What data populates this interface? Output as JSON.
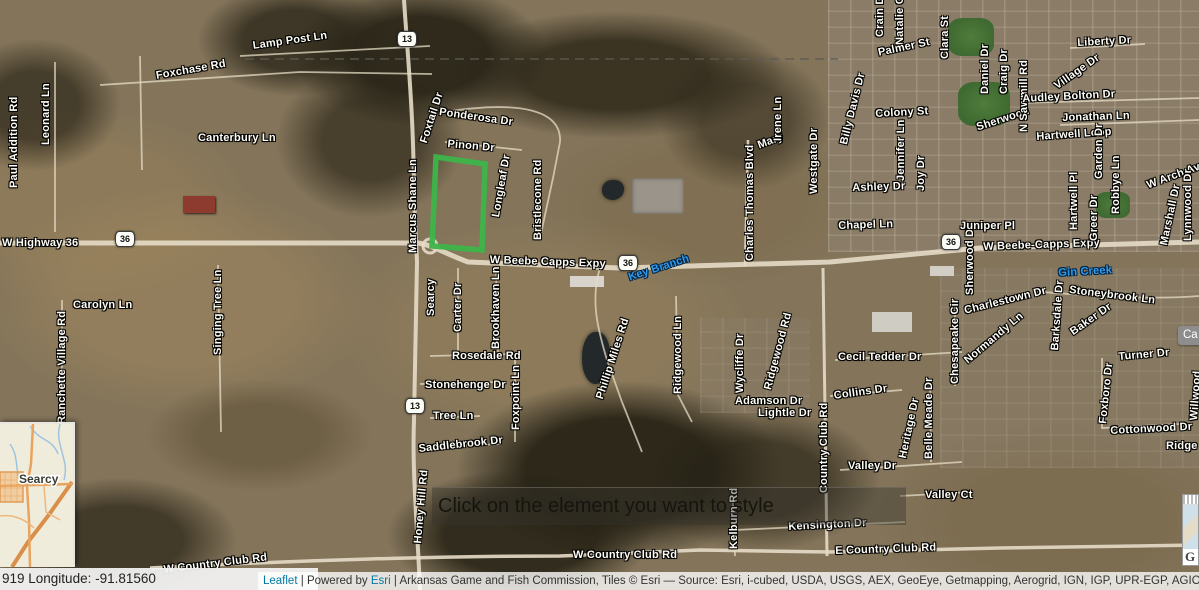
{
  "map": {
    "overlay_tooltip": "Click on the element you want to style",
    "coordinate_bar": "919 Longitude: -91.81560",
    "attribution": {
      "leaflet_link": "Leaflet",
      "divider": "|",
      "powered_prefix": "Powered by",
      "esri_link": "Esri",
      "tail": "| Arkansas Game and Fish Commission, Tiles © Esri — Source: Esri, i-cubed, USDA, USGS, AEX, GeoEye, Getmapping, Aerogrid, IGN, IGP, UPR-EGP, AGIO, and the GIS Use"
    },
    "inset": {
      "city_label": "Searcy"
    },
    "cutoff_button_label": "Ca",
    "corner_widget_letter": "G",
    "highlight_polygon": {
      "color": "#3db54a",
      "points": "436,157 485,164 482,250 432,246"
    },
    "shields": [
      {
        "text": "36",
        "x": 115,
        "y": 231
      },
      {
        "text": "36",
        "x": 618,
        "y": 255
      },
      {
        "text": "36",
        "x": 941,
        "y": 234
      },
      {
        "text": "13",
        "x": 397,
        "y": 31
      },
      {
        "text": "13",
        "x": 405,
        "y": 398
      }
    ],
    "street_labels": [
      {
        "text": "Lamp Post Ln",
        "x": 252,
        "y": 40,
        "r": -8
      },
      {
        "text": "Foxchase Rd",
        "x": 155,
        "y": 70,
        "r": -10
      },
      {
        "text": "Canterbury Ln",
        "x": 198,
        "y": 132
      },
      {
        "text": "Paul Addition Rd",
        "x": 8,
        "y": 188,
        "r": -90
      },
      {
        "text": "Leonard Ln",
        "x": 40,
        "y": 145,
        "r": -90
      },
      {
        "text": "W Highway 36",
        "x": 2,
        "y": 237
      },
      {
        "text": "Carolyn Ln",
        "x": 73,
        "y": 299
      },
      {
        "text": "Singing Tree Ln",
        "x": 212,
        "y": 355,
        "r": -90
      },
      {
        "text": "Ranchette Village Rd",
        "x": 56,
        "y": 424,
        "r": -90
      },
      {
        "text": "W Country Club Rd",
        "x": 163,
        "y": 564,
        "r": -7
      },
      {
        "text": "Foxtail Dr",
        "x": 418,
        "y": 141,
        "r": -72
      },
      {
        "text": "Ponderosa Dr",
        "x": 440,
        "y": 106,
        "r": 8
      },
      {
        "text": "Pinon Dr",
        "x": 448,
        "y": 138,
        "r": 5
      },
      {
        "text": "Longleaf Dr",
        "x": 490,
        "y": 216,
        "r": -80
      },
      {
        "text": "Bristlecone Rd",
        "x": 532,
        "y": 240,
        "r": -90
      },
      {
        "text": "Marcus Shane Ln",
        "x": 407,
        "y": 253,
        "r": -90
      },
      {
        "text": "W Beebe Capps Expy",
        "x": 490,
        "y": 254,
        "r": 2
      },
      {
        "text": "Searcy",
        "x": 425,
        "y": 316,
        "r": -90
      },
      {
        "text": "Carter Dr",
        "x": 452,
        "y": 332,
        "r": -90
      },
      {
        "text": "Brookhaven Ln",
        "x": 490,
        "y": 349,
        "r": -90
      },
      {
        "text": "Rosedale Rd",
        "x": 452,
        "y": 350
      },
      {
        "text": "Stonehenge Dr",
        "x": 425,
        "y": 379
      },
      {
        "text": "Foxpoint Ln",
        "x": 510,
        "y": 430,
        "r": -90
      },
      {
        "text": "Tree Ln",
        "x": 433,
        "y": 410
      },
      {
        "text": "Saddlebrook Dr",
        "x": 418,
        "y": 443,
        "r": -6
      },
      {
        "text": "Honey Hill Rd",
        "x": 412,
        "y": 543,
        "r": -85
      },
      {
        "text": "Phillip Miles Rd",
        "x": 594,
        "y": 397,
        "r": -72
      },
      {
        "text": "Ridgewood Ln",
        "x": 672,
        "y": 394,
        "r": -90
      },
      {
        "text": "Kelburn Rd",
        "x": 728,
        "y": 549,
        "r": -90
      },
      {
        "text": "W Country Club Rd",
        "x": 573,
        "y": 549
      },
      {
        "text": "Kensington Dr",
        "x": 788,
        "y": 521,
        "r": -3
      },
      {
        "text": "E Country Club Rd",
        "x": 835,
        "y": 545,
        "r": -2
      },
      {
        "text": "Valley Dr",
        "x": 848,
        "y": 460
      },
      {
        "text": "Valley Ct",
        "x": 925,
        "y": 489
      },
      {
        "text": "Country Club Rd",
        "x": 818,
        "y": 493,
        "r": -90
      },
      {
        "text": "Adamson Dr",
        "x": 735,
        "y": 395
      },
      {
        "text": "Lightle Dr",
        "x": 758,
        "y": 407
      },
      {
        "text": "Collins Dr",
        "x": 833,
        "y": 390,
        "r": -8
      },
      {
        "text": "Cecil Tedder Dr",
        "x": 838,
        "y": 351
      },
      {
        "text": "Wycliffe Dr",
        "x": 734,
        "y": 393,
        "r": -90
      },
      {
        "text": "Ridgewood Rd",
        "x": 762,
        "y": 388,
        "r": -75
      },
      {
        "text": "Belle Meade Dr",
        "x": 923,
        "y": 459,
        "r": -90
      },
      {
        "text": "Heritage Dr",
        "x": 897,
        "y": 457,
        "r": -78
      },
      {
        "text": "Chesapeake Cir",
        "x": 949,
        "y": 384,
        "r": -90
      },
      {
        "text": "Normandy Ln",
        "x": 962,
        "y": 357,
        "r": -40
      },
      {
        "text": "Charlestown Dr",
        "x": 963,
        "y": 305,
        "r": -14
      },
      {
        "text": "Sherwood Dr",
        "x": 964,
        "y": 295,
        "r": -90
      },
      {
        "text": "Stoneybrook Ln",
        "x": 1070,
        "y": 284,
        "r": 7
      },
      {
        "text": "Barksdale Dr",
        "x": 1049,
        "y": 350,
        "r": -86
      },
      {
        "text": "Baker Dr",
        "x": 1068,
        "y": 328,
        "r": -35
      },
      {
        "text": "Juniper Pl",
        "x": 960,
        "y": 220
      },
      {
        "text": "W Beebe-Capps Expy",
        "x": 983,
        "y": 241,
        "r": -2
      },
      {
        "text": "Turner Dr",
        "x": 1118,
        "y": 351,
        "r": -5
      },
      {
        "text": "Foxboro Dr",
        "x": 1097,
        "y": 423,
        "r": -84
      },
      {
        "text": "Willwood",
        "x": 1188,
        "y": 420,
        "r": -86
      },
      {
        "text": "Cottonwood Dr",
        "x": 1110,
        "y": 425,
        "r": -3
      },
      {
        "text": "Ridge R",
        "x": 1166,
        "y": 440
      },
      {
        "text": "Charles Thomas Blvd",
        "x": 744,
        "y": 261,
        "r": -90
      },
      {
        "text": "Mary",
        "x": 756,
        "y": 140,
        "r": -20
      },
      {
        "text": "Irene Ln",
        "x": 772,
        "y": 141,
        "r": -90
      },
      {
        "text": "Westgate Dr",
        "x": 808,
        "y": 194,
        "r": -90
      },
      {
        "text": "Billy Davis Dr",
        "x": 838,
        "y": 143,
        "r": -76
      },
      {
        "text": "Colony St",
        "x": 875,
        "y": 108,
        "r": -3
      },
      {
        "text": "Jennifer Ln",
        "x": 895,
        "y": 181,
        "r": -90
      },
      {
        "text": "Joy Dr",
        "x": 915,
        "y": 191,
        "r": -90
      },
      {
        "text": "Ashley Dr",
        "x": 852,
        "y": 182,
        "r": -2
      },
      {
        "text": "Chapel Ln",
        "x": 838,
        "y": 220,
        "r": -2
      },
      {
        "text": "Crain Dr",
        "x": 874,
        "y": 37,
        "r": -90
      },
      {
        "text": "Natalie Cir",
        "x": 894,
        "y": 45,
        "r": -90
      },
      {
        "text": "Palmer St",
        "x": 877,
        "y": 47,
        "r": -12
      },
      {
        "text": "Clara St",
        "x": 939,
        "y": 59,
        "r": -90
      },
      {
        "text": "Daniel Dr",
        "x": 979,
        "y": 94,
        "r": -90
      },
      {
        "text": "Craig Dr",
        "x": 998,
        "y": 94,
        "r": -90
      },
      {
        "text": "Sherwood",
        "x": 975,
        "y": 122,
        "r": -18
      },
      {
        "text": "N Sawmill Rd",
        "x": 1018,
        "y": 132,
        "r": -90
      },
      {
        "text": "Liberty Dr",
        "x": 1077,
        "y": 37,
        "r": -3
      },
      {
        "text": "Village Dr",
        "x": 1052,
        "y": 82,
        "r": -35
      },
      {
        "text": "Audley Bolton Dr",
        "x": 1022,
        "y": 93,
        "r": -3
      },
      {
        "text": "Jonathan Ln",
        "x": 1062,
        "y": 112,
        "r": -2
      },
      {
        "text": "Hartwell Loop",
        "x": 1036,
        "y": 131,
        "r": -4
      },
      {
        "text": "Garden Dr",
        "x": 1093,
        "y": 179,
        "r": -90
      },
      {
        "text": "Hartwell Pl",
        "x": 1068,
        "y": 230,
        "r": -90
      },
      {
        "text": "Greer Dr",
        "x": 1088,
        "y": 241,
        "r": -90
      },
      {
        "text": "Robbye Ln",
        "x": 1110,
        "y": 214,
        "r": -90
      },
      {
        "text": "W Arch Ave",
        "x": 1145,
        "y": 180,
        "r": -20
      },
      {
        "text": "Marshall Dr",
        "x": 1158,
        "y": 244,
        "r": -78
      },
      {
        "text": "Lynnwood Dr",
        "x": 1182,
        "y": 241,
        "r": -90
      },
      {
        "text": "Key Branch",
        "x": 627,
        "y": 272,
        "r": -18,
        "k": "water"
      },
      {
        "text": "Gin Creek",
        "x": 1058,
        "y": 267,
        "r": -3,
        "k": "water"
      }
    ]
  }
}
